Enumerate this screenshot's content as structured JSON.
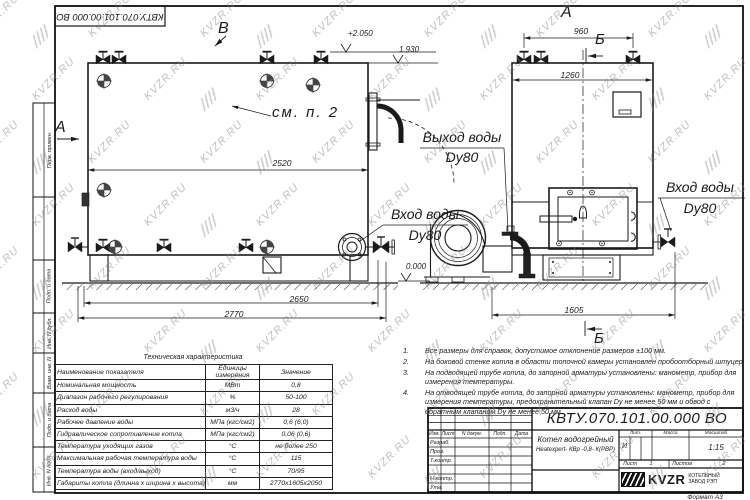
{
  "watermark": {
    "text": "KVZR.RU"
  },
  "doc_number": "КВТУ.070.101.00.000  ВО",
  "stamp_side": {
    "left_boxes": [
      "Перв. примен.",
      "",
      "Подп. и дата",
      "Инв. N дубл.",
      "Взам. инв. N",
      "Подп. и дата",
      "Инв. N подл."
    ]
  },
  "drawing": {
    "section_markers": {
      "a_left": "А",
      "a_top": "А",
      "b_top": "Б",
      "b_bottom": "Б",
      "v_top": "В"
    },
    "callouts": {
      "see_note": "см. п. 2",
      "outlet_line1": "Выход воды",
      "outlet_line2": "Dy80",
      "inlet_left_line1": "Вход воды",
      "inlet_left_line2": "Dy80",
      "inlet_right_line1": "Вход воды",
      "inlet_right_line2": "Dy80"
    },
    "dimensions": {
      "d2520": "2520",
      "d2650": "2650",
      "d2770": "2770",
      "d960": "960",
      "d1260": "1260",
      "d1605": "1605"
    },
    "elevations": {
      "e_top": "+2.050",
      "e_mid": "1.930",
      "e_zero": "0.000"
    }
  },
  "tech_table": {
    "title": "Техническая характеристика",
    "headers": [
      "Наименование показателя",
      "Единицы измерения",
      "Значение"
    ],
    "rows": [
      [
        "Номинальная мощность",
        "МВт",
        "0,8"
      ],
      [
        "Диапазон рабочего регулирования",
        "%",
        "50-100"
      ],
      [
        "Расход воды",
        "м3/ч",
        "28"
      ],
      [
        "Рабочее давление воды",
        "МПа (кгс/см2)",
        "0,6 (6,0)"
      ],
      [
        "Гидравлическое сопротивление котла",
        "МПа (кгс/см2)",
        "0,06 (0,6)"
      ],
      [
        "Температура уходящих газов",
        "°С",
        "не более 250"
      ],
      [
        "Максимальная рабочая температура воды",
        "°С",
        "115"
      ],
      [
        "Температура воды (вход/выход)",
        "°С",
        "70/95"
      ],
      [
        "Габариты котла (длинна х ширина х высота)",
        "мм",
        "2770х1605х2050"
      ]
    ]
  },
  "notes": [
    {
      "num": "1.",
      "text": "Все размеры для справок, допустимое отклонение размеров ±100 мм."
    },
    {
      "num": "2.",
      "text": "На боковой стенке котла в области топочной камеры установлен пробоотборный штуцер"
    },
    {
      "num": "3.",
      "text": "На  подводящей трубе котла, до запорной арматуры установлены: манометр, прибор для измерения температуры."
    },
    {
      "num": "4.",
      "text": "На отводящей трубе котла, до запорной арматуры установлены: манометр, прибор для измерения температуры, предохранительный клапан  Dу не менее  50 мм и обвод с обратным клапаном  Dу не менее  50 мм."
    }
  ],
  "title_block": {
    "rev_headers": [
      "Изм.",
      "Лист",
      "N докум.",
      "Подп.",
      "Дата"
    ],
    "row_labels": [
      "Разраб.",
      "Пров.",
      "Т.контр.",
      "Н.контр.",
      "Утв."
    ],
    "product_name_line1": "Котел водогрейный",
    "product_name_line2": "Heatexpert- КВр -0,8- К(РВР)",
    "lit_header": "Лит.",
    "mass_header": "Масса",
    "scale_header": "Масштаб",
    "lit_value": "И",
    "scale_value": "1:15",
    "sheet_label": "Лист",
    "sheet_value": "1",
    "sheets_label": "Листов",
    "sheets_value": "2",
    "company_logo_text": "KVZR",
    "company_name_line1": "КОТЕЛЬНЫЙ",
    "company_name_line2": "ЗАВОД РЭП",
    "format_label": "Формат  А3"
  }
}
